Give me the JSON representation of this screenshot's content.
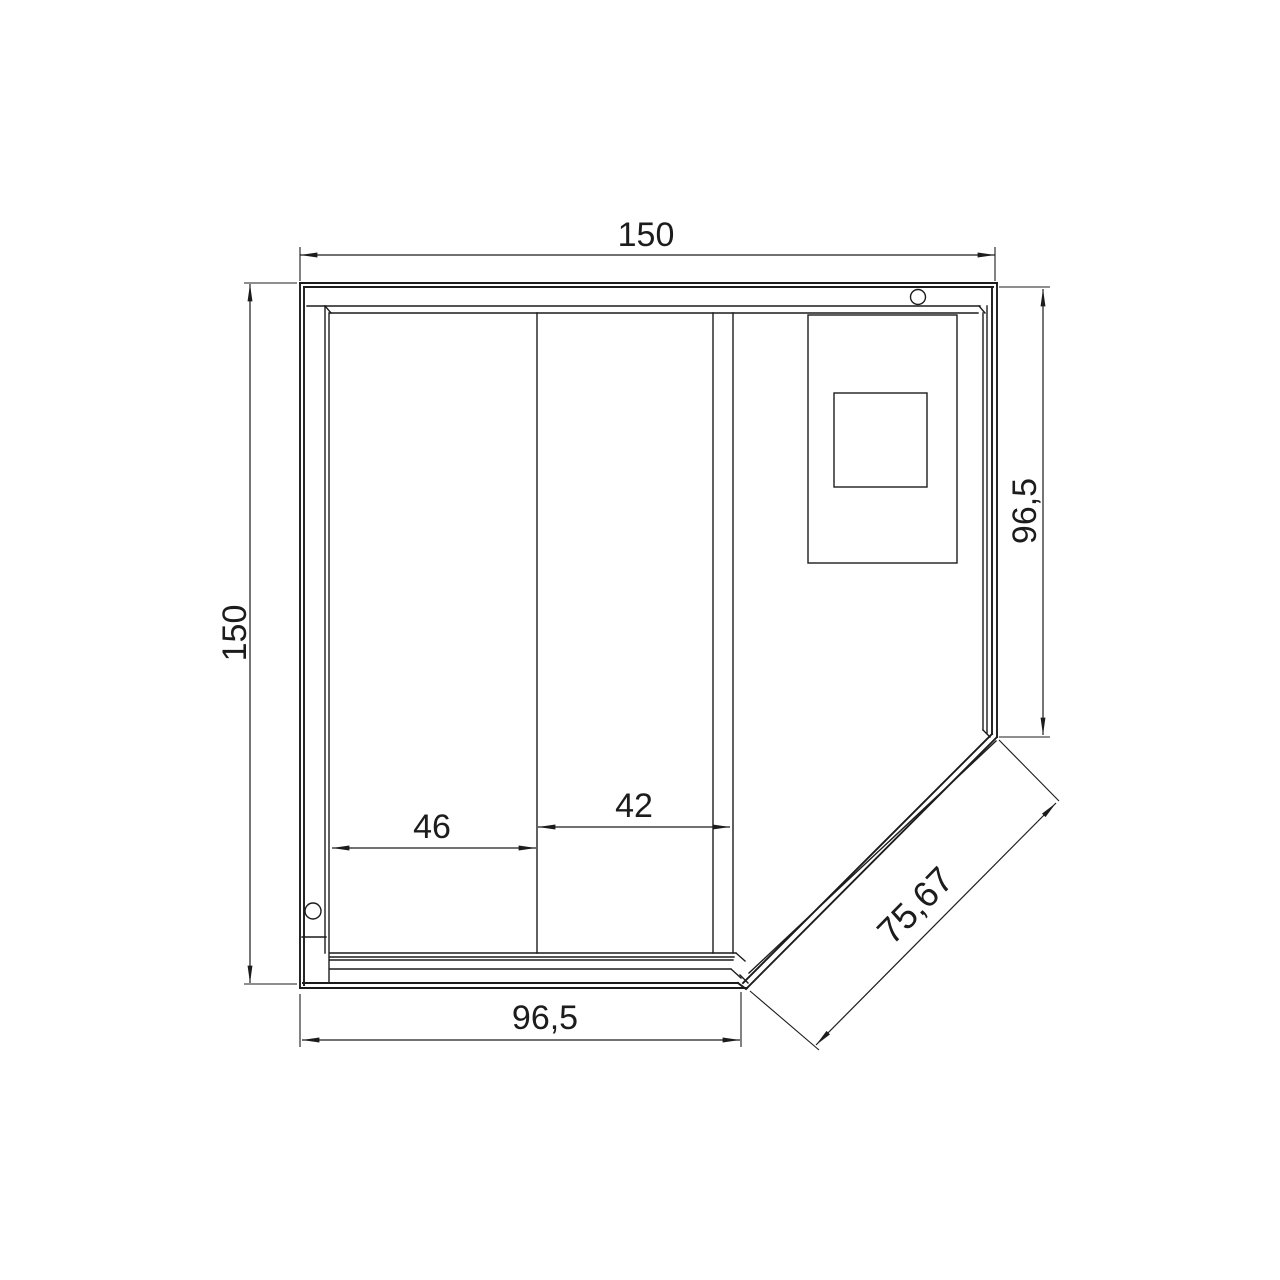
{
  "drawing": {
    "dimensions": {
      "top_width": {
        "value": "150"
      },
      "left_height": {
        "value": "150"
      },
      "right_height": {
        "value": "96,5"
      },
      "bottom_width": {
        "value": "96,5"
      },
      "panel_left": {
        "value": "46"
      },
      "panel_right": {
        "value": "42"
      },
      "diagonal": {
        "value": "75,67"
      }
    },
    "colors": {
      "line": "#1c1c1c",
      "background": "#ffffff"
    }
  }
}
